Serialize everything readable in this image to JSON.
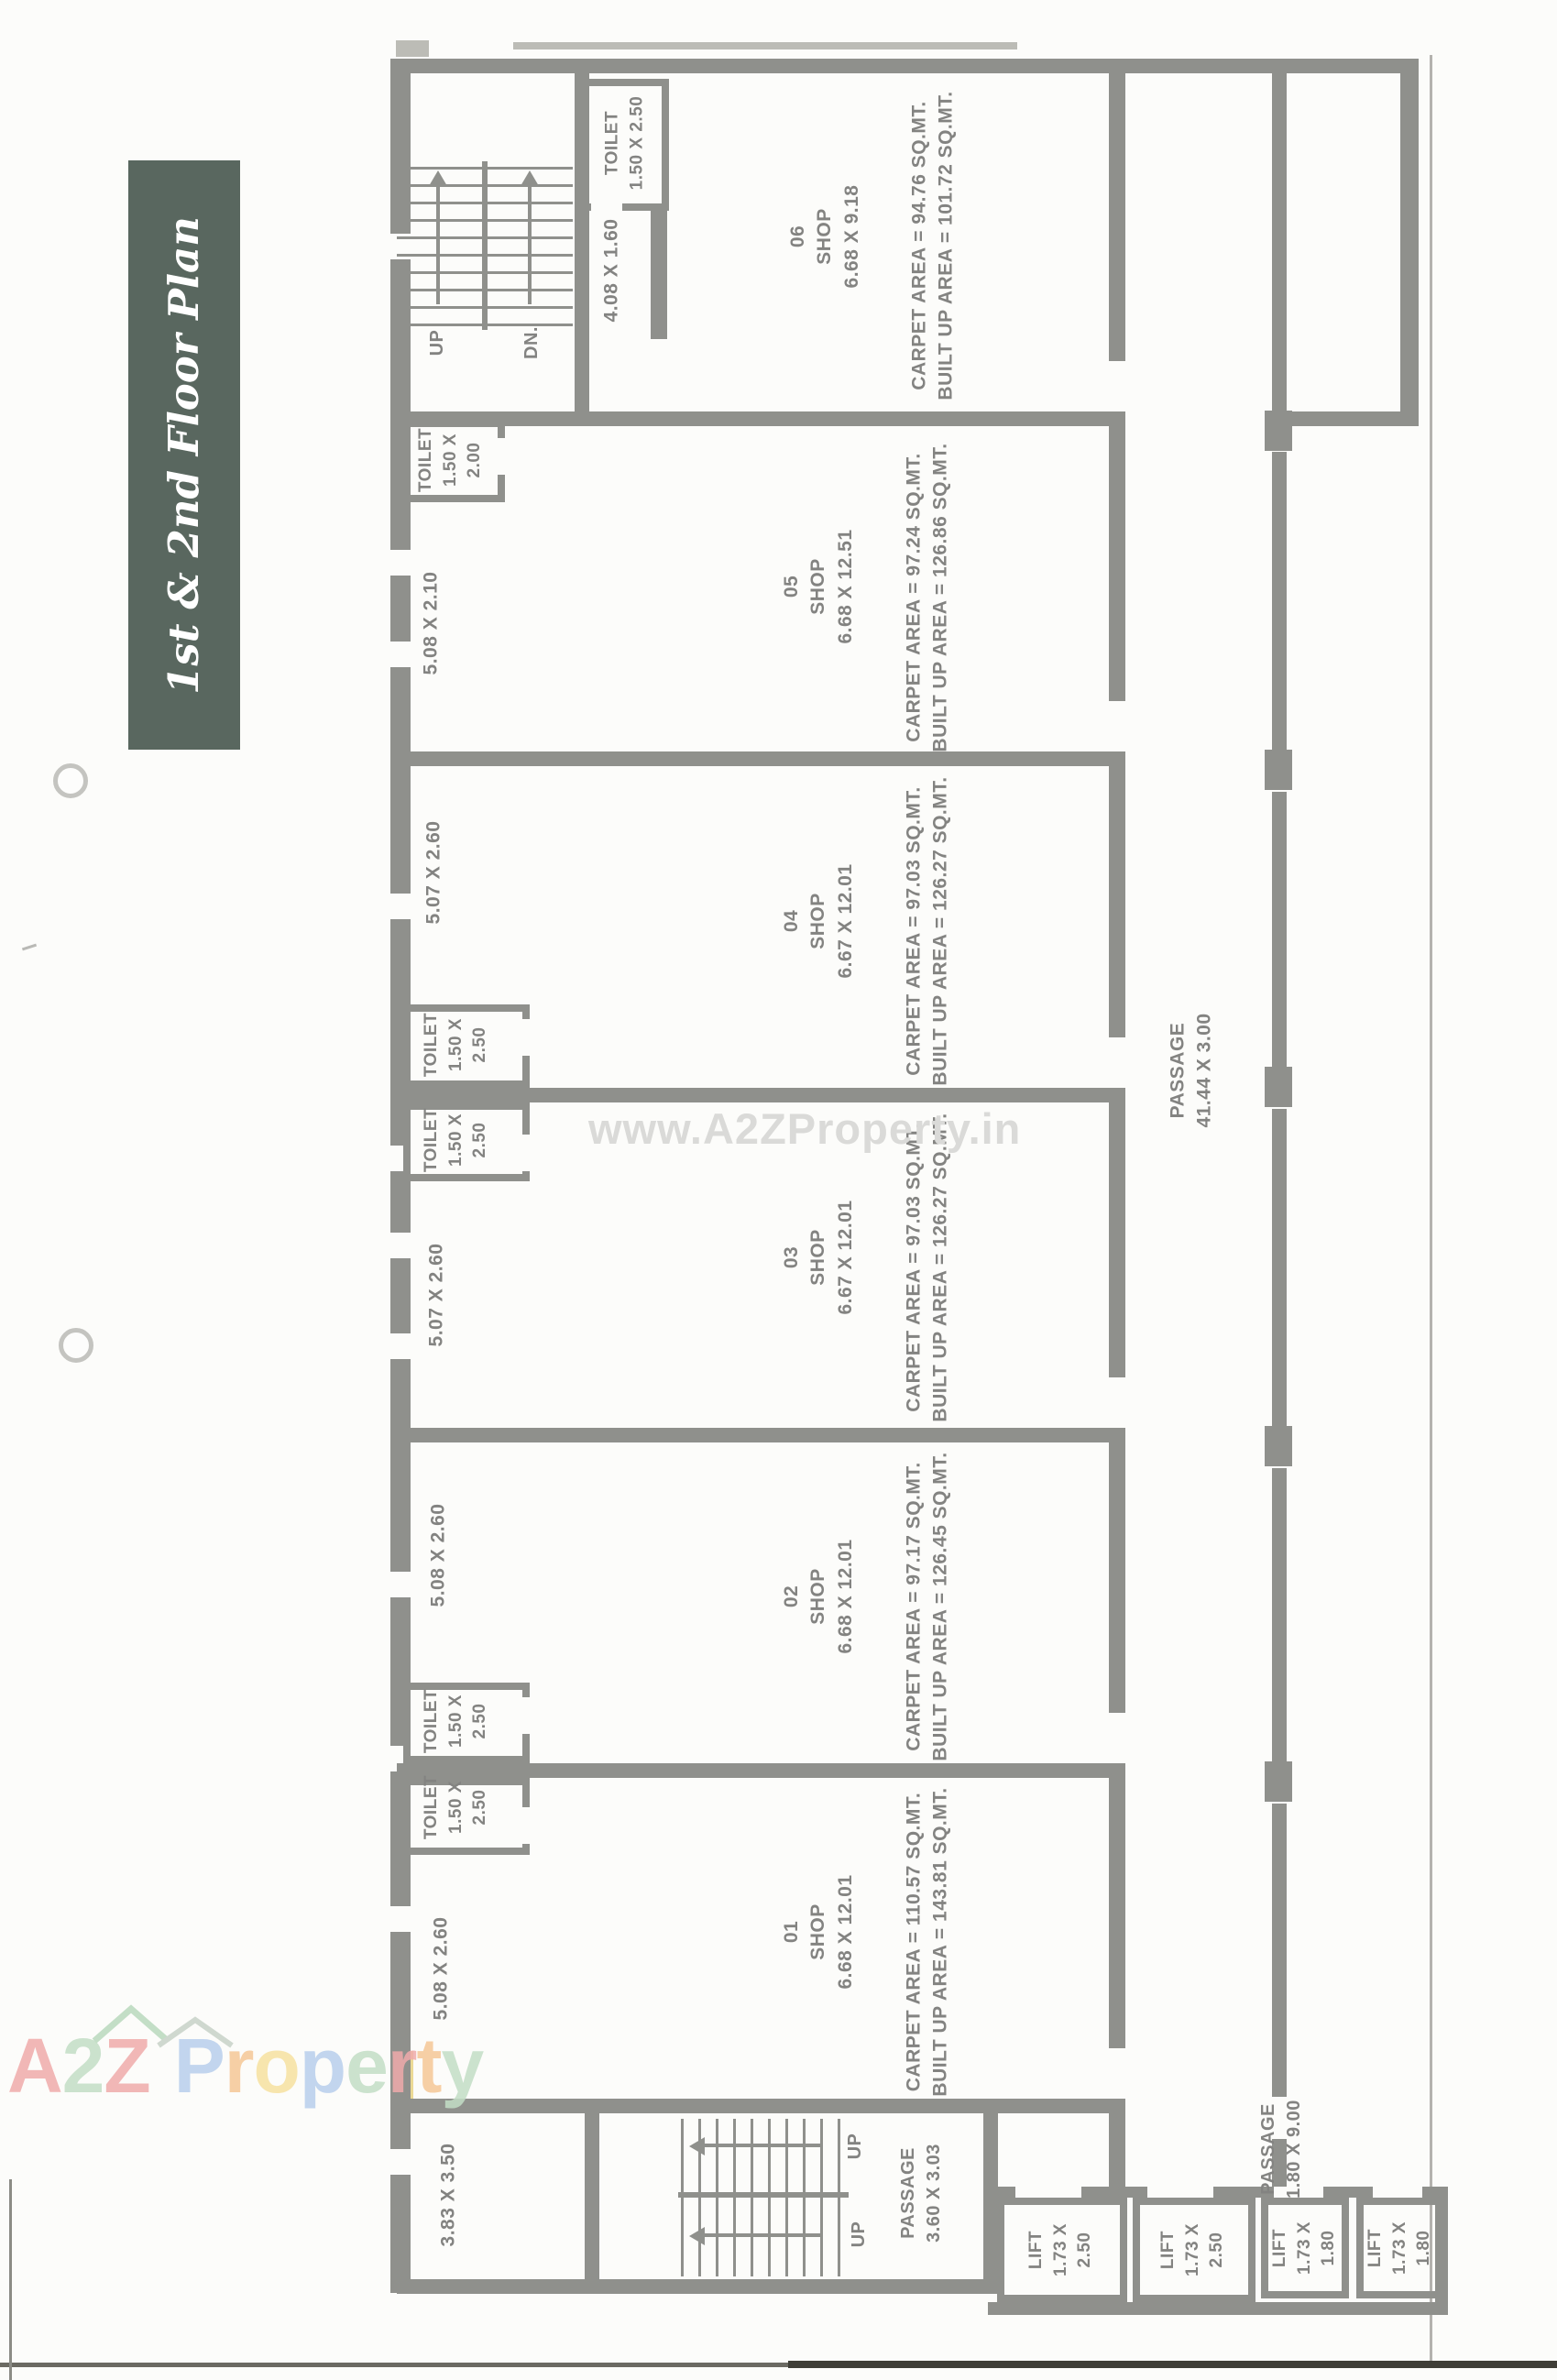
{
  "banner": {
    "title": "1st & 2nd Floor Plan",
    "bg_color": "#59675f",
    "text_color": "#ffffff"
  },
  "watermark": {
    "text": "www.A2ZProperty.in",
    "color": "#dadad8"
  },
  "logo": {
    "letters": [
      {
        "ch": "A",
        "color": "#f0abab"
      },
      {
        "ch": "2",
        "color": "#c3dec6"
      },
      {
        "ch": "Z",
        "color": "#f0abab"
      },
      {
        "ch": "P",
        "color": "#b9cfec"
      },
      {
        "ch": "r",
        "color": "#f6c897"
      },
      {
        "ch": "o",
        "color": "#f7e2a0"
      },
      {
        "ch": "p",
        "color": "#b9cfec"
      },
      {
        "ch": "e",
        "color": "#c3dec6"
      },
      {
        "ch": "r",
        "color": "#f0abab"
      },
      {
        "ch": "t",
        "color": "#f6c897"
      },
      {
        "ch": "y",
        "color": "#c3dec6"
      }
    ]
  },
  "plan": {
    "wall_color": "#8f908c",
    "label_color": "#838381",
    "shops": [
      {
        "num": "01",
        "type": "SHOP",
        "size": "6.68 X 12.01",
        "carpet": "CARPET  AREA  =  110.57 SQ.MT.",
        "builtup": "BUILT UP  AREA  =  143.81 SQ.MT.",
        "rear_dim": "5.08 X 2.60"
      },
      {
        "num": "02",
        "type": "SHOP",
        "size": "6.68 X 12.01",
        "carpet": "CARPET  AREA  =  97.17 SQ.MT.",
        "builtup": "BUILT UP  AREA  =  126.45 SQ.MT.",
        "rear_dim": "5.08 X 2.60"
      },
      {
        "num": "03",
        "type": "SHOP",
        "size": "6.67 X 12.01",
        "carpet": "CARPET  AREA  =  97.03 SQ.MT.",
        "builtup": "BUILT UP  AREA  =  126.27 SQ.MT.",
        "rear_dim": "5.07 X 2.60"
      },
      {
        "num": "04",
        "type": "SHOP",
        "size": "6.67 X 12.01",
        "carpet": "CARPET  AREA  =  97.03 SQ.MT.",
        "builtup": "BUILT UP  AREA  =  126.27 SQ.MT.",
        "rear_dim": "5.07 X 2.60"
      },
      {
        "num": "05",
        "type": "SHOP",
        "size": "6.68 X 12.51",
        "carpet": "CARPET  AREA  =  97.24 SQ.MT.",
        "builtup": "BUILT UP  AREA  =  126.86 SQ.MT.",
        "rear_dim": "5.08 X 2.10"
      },
      {
        "num": "06",
        "type": "SHOP",
        "size": "6.68 X 9.18",
        "carpet": "CARPET  AREA  =  94.76 SQ.MT.",
        "builtup": "BUILT UP  AREA  =  101.72 SQ.MT.",
        "rear_dim": ""
      }
    ],
    "toilets": {
      "top": "TOILET\n1.50 X 2.50",
      "s05": "TOILET\n1.50 X\n2.00",
      "s04": "TOILET\n1.50 X\n2.50",
      "s03": "TOILET\n1.50 X\n2.50",
      "s02": "TOILET\n1.50 X\n2.50",
      "s01": "TOILET\n1.50 X\n2.50"
    },
    "lifts": [
      {
        "label": "LIFT\n1.73 X\n2.50"
      },
      {
        "label": "LIFT\n1.73 X\n2.50"
      },
      {
        "label": "LIFT\n1.73 X\n1.80"
      },
      {
        "label": "LIFT\n1.73 X\n1.80"
      }
    ],
    "passages": {
      "main": "PASSAGE\n41.44 X 3.00",
      "stair": "PASSAGE\n3.60 X 3.03",
      "lift": "PASSAGE\n1.80 X 9.00"
    },
    "stairs": {
      "top_up": "UP",
      "top_dn": "DN.",
      "bottom_up1": "UP",
      "bottom_up2": "UP"
    },
    "lobby_dim": "4.08 X 1.60",
    "corner_room_dim": "3.83 X 3.50"
  }
}
